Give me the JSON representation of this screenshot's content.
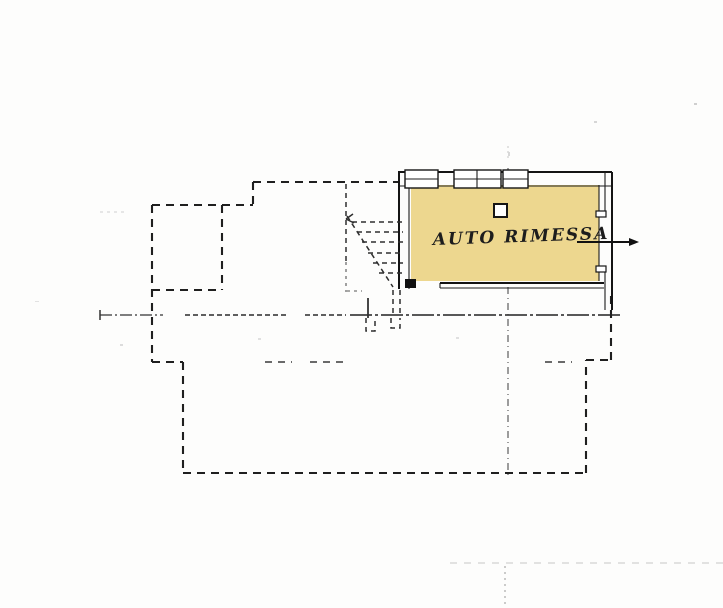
{
  "plan": {
    "room": {
      "label": "AUTO RIMESSA"
    },
    "colors": {
      "room_highlight": "#EDD78F",
      "ink": "#1c1c1c",
      "paper": "#fdfdfc"
    },
    "symbols": [
      {
        "name": "entrance-arrow",
        "meaning": "access direction into garage"
      },
      {
        "name": "stairs-symbol",
        "meaning": "dashed staircase"
      },
      {
        "name": "flue-symbol",
        "meaning": "small square duct in room"
      },
      {
        "name": "window-symbol",
        "meaning": "openings on top wall"
      }
    ]
  }
}
